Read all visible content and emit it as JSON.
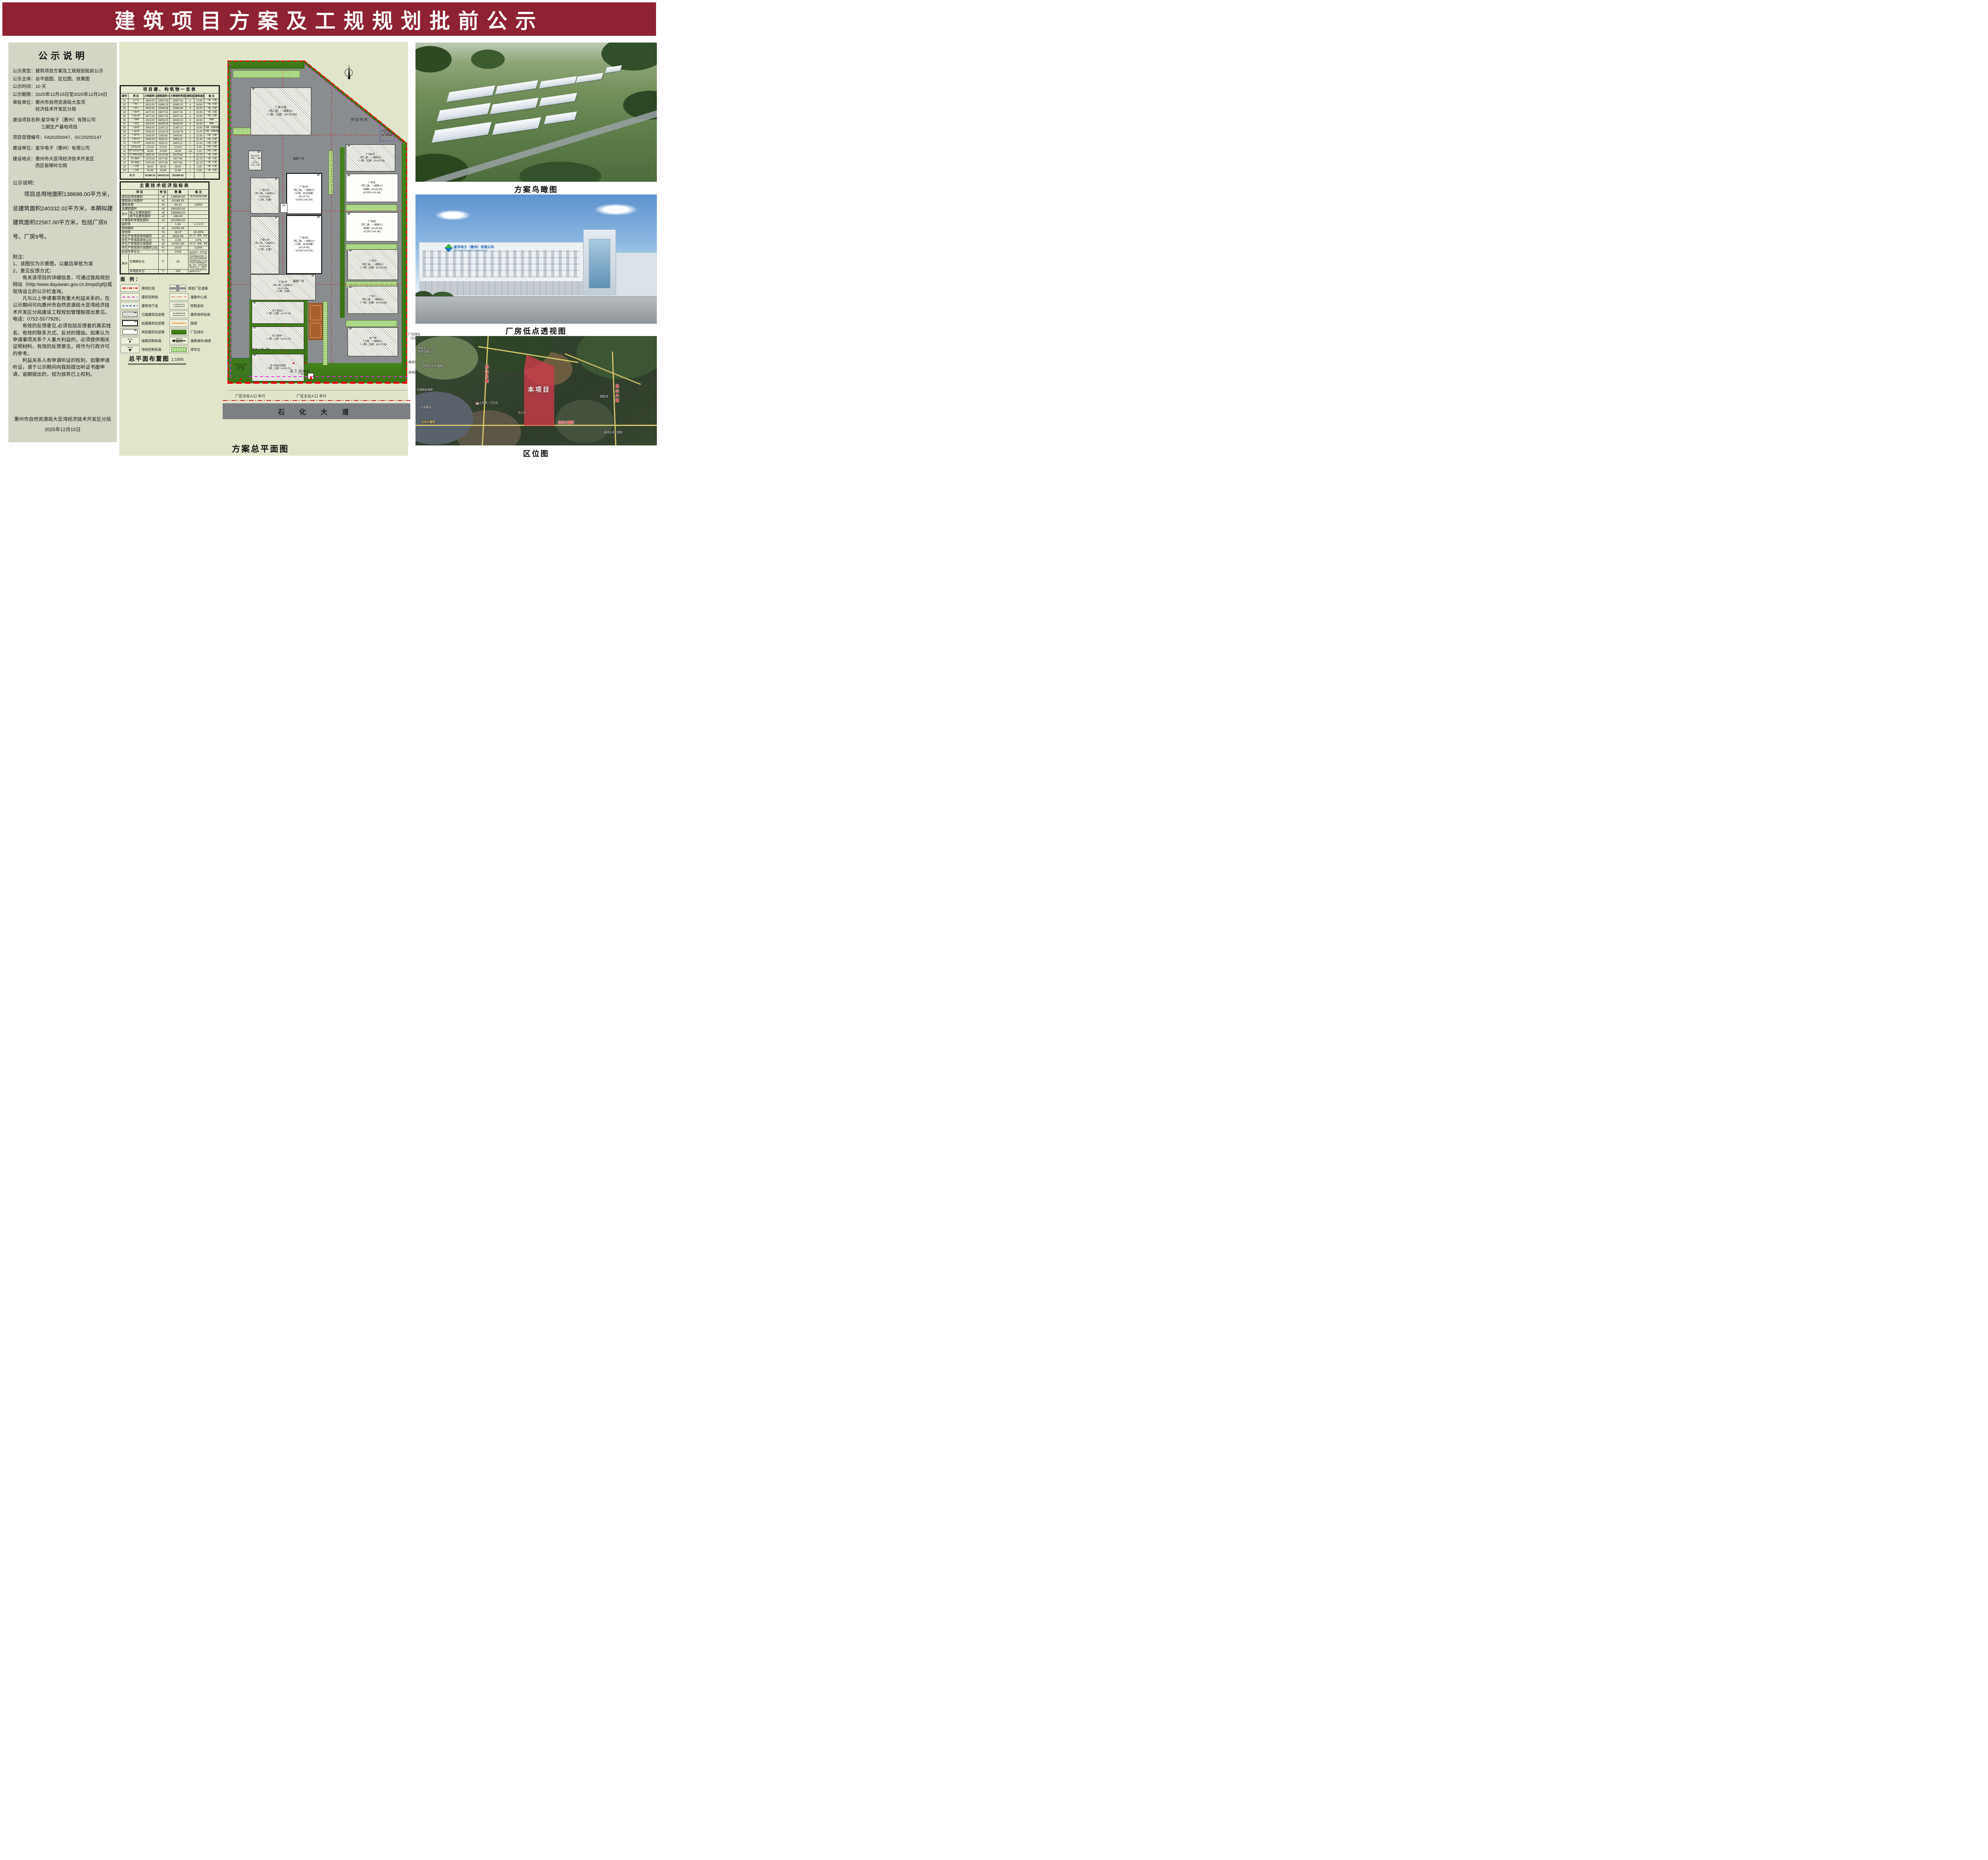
{
  "header": {
    "title": "建筑项目方案及工规规划批前公示"
  },
  "left": {
    "title": "公示说明",
    "fields": [
      {
        "label": "公示类型：",
        "value": "建筑项目方案及工规规划批前公示"
      },
      {
        "label": "公示主体：",
        "value": "总平面图、区位图、效果图"
      },
      {
        "label": "公示时间：",
        "value": "10 天"
      },
      {
        "label": "公示期限：",
        "value": "2025年12月15日至2025年12月24日"
      },
      {
        "label": "审批单位：",
        "value": "惠州市自然资源局大亚湾\n经济技术开发区分局"
      },
      {
        "label": "建设项目名称:",
        "value": "星华电子（惠州）有限公司\n三期生产基地项目"
      },
      {
        "label": "项目受理编号：",
        "value": "FA20250047、GC20250147"
      },
      {
        "label": "建设单位：",
        "value": "星华电子（惠州）有限公司"
      },
      {
        "label": "建设地点：",
        "value": "惠州市大亚湾经济技术开发区\n西区板樟岭北侧"
      }
    ],
    "desc_title": "公示说明：",
    "desc": "项目总用地面积138696.00平方米，总建筑面积240332.02平方米，本期拟建建筑面积22587.00平方米，包括厂房8号、厂房9号。",
    "notes_title": "附注：",
    "notes": [
      "1、该图仅为示意图，以最后审批为准",
      "2、意见反馈方式：",
      "　　有关该项目的详细信息，可通过我局规划网站（http:/www.dayawan.gov.cn.bmpd/gtfj)或现场设立的公示栏查询。",
      "　　凡与以上申请事项有重大利益关系的，在公示期间可向惠州市自然资源局大亚湾经济技术开发区分局建设工程规划管理股提出意见。",
      "电话：0752-5577926；",
      "　　有效的反馈意见,必须包括反馈者的真实姓名、有效的联系方式、反对的理由。如果认为申请事项关系个人重大利益的，必须提供相关证明材料，有效的反馈意见，将作为行政许可的参考。",
      "　　利益关系人有申请听证的权利，如需申请听证，请于公示期间向我局提出听证书面申请，逾期提出的，视为放弃已上权利。"
    ],
    "org": "惠州市自然资源局大亚湾经济技术开发区分局",
    "date": "2025年12月15日"
  },
  "buildings": {
    "title": "项目建、构筑物一览表",
    "headers": [
      "编号",
      "项  目",
      "占地面积㎡",
      "建筑面积㎡",
      "计算容积率面积㎡",
      "建筑层数",
      "建筑高度m",
      "备 注"
    ],
    "rows": [
      {
        "no": "01",
        "name": "主厂房",
        "area": "4606.00",
        "gfa": "18597.63",
        "far": "18597.63",
        "floors": "4",
        "height": "17.85",
        "note": "一期，已建"
      },
      {
        "no": "02",
        "name": "厂房二",
        "area": "4523.00",
        "gfa": "18360.23",
        "far": "18360.23",
        "floors": "4",
        "height": "19.65",
        "note": "一期，已建"
      },
      {
        "no": "03",
        "name": "厂房三",
        "area": "4523.00",
        "gfa": "18344.98",
        "far": "18344.98",
        "floors": "4",
        "height": "20.00",
        "note": "一期，已建"
      },
      {
        "no": "04",
        "name": "厂房6号",
        "area": "4877.00",
        "gfa": "19877.91",
        "far": "19877.91",
        "floors": "4",
        "height": "20.95",
        "note": "一期，已建"
      },
      {
        "no": "05",
        "name": "厂房10号",
        "area": "4877.00",
        "gfa": "19877.91",
        "far": "19877.91",
        "floors": "4",
        "height": "20.95",
        "note": "一期，已建"
      },
      {
        "no": "06",
        "name": "厂房四",
        "area": "4523.00",
        "gfa": "36435.00",
        "far": "36435.00",
        "floors": "8",
        "height": "43.90",
        "note": "四期"
      },
      {
        "no": "07",
        "name": "厂房五",
        "area": "4523.00",
        "gfa": "36435.00",
        "far": "36435.00",
        "floors": "8",
        "height": "43.90",
        "note": "四期"
      },
      {
        "no": "08",
        "name": "厂房8号",
        "area": "5493.00",
        "gfa": "11367.22",
        "far": "11367.22",
        "floors": "2",
        "height": "14.60",
        "note": "三期，本期拟建"
      },
      {
        "no": "09",
        "name": "厂房9号",
        "area": "5400.00",
        "gfa": "11219.78",
        "far": "11219.78",
        "floors": "2",
        "height": "14.70",
        "note": "三期，本期拟建"
      },
      {
        "no": "10",
        "name": "厂房7号",
        "area": "3200.00",
        "gfa": "3240.63",
        "far": "6440.63",
        "floors": "1",
        "height": "11.00",
        "note": "二期，已建"
      },
      {
        "no": "11",
        "name": "厂房11号",
        "area": "4200.00",
        "gfa": "4253.12",
        "far": "8453.12",
        "floors": "1",
        "height": "11.20",
        "note": "二期，已建"
      },
      {
        "no": "12",
        "name": "厂房12号",
        "area": "4200.00",
        "gfa": "4253.12",
        "far": "8453.12",
        "floors": "1",
        "height": "11.10",
        "note": "二期，已建"
      },
      {
        "no": "13",
        "name": "化学品仓库",
        "area": "273.00",
        "gfa": "273.00",
        "far": "273.00",
        "floors": "1",
        "height": "5.00",
        "note": "二期，已建"
      },
      {
        "no": "14",
        "name": "地下生活/生产/消防水池及泵房",
        "area": "38.69",
        "gfa": "374.69",
        "far": "38.69",
        "floors": "-1/1",
        "height": "3.10",
        "note": "二期，已建"
      },
      {
        "no": "15",
        "name": "员工宿舍及食堂",
        "area": "3695.00",
        "gfa": "19178.82",
        "far": "19178.82",
        "floors": "7",
        "height": "22.75",
        "note": "一期，已建"
      },
      {
        "no": "16",
        "name": "员工宿舍一",
        "area": "1075.00",
        "gfa": "9077.66",
        "far": "9077.66",
        "floors": "7",
        "height": "22.75",
        "note": "一期，已建"
      },
      {
        "no": "17",
        "name": "员工宿舍二",
        "area": "1075.00",
        "gfa": "9077.66",
        "far": "9077.66",
        "floors": "7",
        "height": "22.75",
        "note": "一期，已建"
      },
      {
        "no": "18",
        "name": "门卫室",
        "area": "36.00",
        "gfa": "36.00",
        "far": "36.00",
        "floors": "1",
        "height": "3.35",
        "note": "一期，已建"
      },
      {
        "no": "19",
        "name": "门卫室",
        "area": "51.66",
        "gfa": "51.66",
        "far": "51.66",
        "floors": "1",
        "height": "3.35",
        "note": "一期，已建"
      }
    ],
    "total_label": "合  计",
    "total": {
      "area": "61189.35",
      "gfa": "240332.02",
      "far": "251596.02"
    }
  },
  "indicators": {
    "title": "主要技术经济指标表",
    "headers": [
      "项    目",
      "单 位",
      "数  量",
      "备 注"
    ],
    "qizhong": "其中",
    "rows": [
      {
        "label": "规划总用地面积",
        "unit": "㎡",
        "value": "138696.00",
        "note": "合计约208.04亩"
      },
      {
        "label": "建筑物占地面积",
        "unit": "㎡",
        "value": "61189.35",
        "note": ""
      },
      {
        "label": "建筑系数",
        "unit": "%",
        "value": "44.12",
        "note": "≥30%"
      },
      {
        "label": "总建筑面积",
        "unit": "㎡",
        "value": "240332.02",
        "note": ""
      },
      {
        "label": "地上总建筑面积",
        "unit": "㎡",
        "value": "239996.02",
        "note": ""
      },
      {
        "label": "地下总建筑面积",
        "unit": "㎡",
        "value": "336.00",
        "note": ""
      },
      {
        "label": "计算容积率建筑面积",
        "unit": "㎡",
        "value": "251596.02",
        "note": ""
      },
      {
        "label": "容积率",
        "unit": "",
        "value": "1.81",
        "note": "1.2-2.0"
      },
      {
        "label": "绿地面积",
        "unit": "㎡",
        "value": "22293.46",
        "note": ""
      },
      {
        "label": "绿地率",
        "unit": "%",
        "value": "16.07",
        "note": "15-20%"
      },
      {
        "label": "非生产性用房用地面积",
        "unit": "㎡",
        "value": "5932.66",
        "note": "含门卫、宿舍、食堂"
      },
      {
        "label": "非生产性用房用地占比",
        "unit": "%",
        "value": "4.28",
        "note": "≤7%"
      },
      {
        "label": "非生产性用房计容面积",
        "unit": "㎡",
        "value": "37421.80",
        "note": "含门卫、宿舍、食堂"
      },
      {
        "label": "非生产性用房计容面积占比",
        "unit": "%",
        "value": "14.87",
        "note": "≤15%"
      },
      {
        "label": "机动车停车位",
        "unit": "个",
        "value": "1018",
        "note": ""
      },
      {
        "label": "无障碍车位",
        "unit": "个",
        "value": "20",
        "note": ""
      },
      {
        "label": "充电桩车位",
        "unit": "个",
        "value": "102",
        "note": ""
      }
    ],
    "parking_note": "地上停车位；生产区设施停车位＞0.3个/100平方米建筑面积计算；行政办公及生活服务配套区设施停车位1.0个/100平方米计容建筑面积计算。其中：生产区设施停车位643个；行政办公及生活服务配套区设施停车位375个"
  },
  "legend": {
    "title": "图 例：",
    "items": [
      "用地红线",
      "建筑控制线",
      "建筑地下室",
      "已建建筑及层数",
      "拟建建筑及层数",
      "规划建筑及层数",
      "道路控制标高",
      "场地控制标高",
      "规划厂区道路",
      "道路中心线",
      "控制坐标",
      "建筑地坪标高",
      "围墙",
      "厂区绿化",
      "道路坡向/坡度",
      "停车位"
    ],
    "sym": {
      "fl_built": "4F",
      "fl_prop": "1F",
      "fl_plan": "4F",
      "elev_road": "40.65",
      "elev_site": "40.00",
      "coord_x": "X=2613453.570",
      "coord_y": "Y=39448814.861",
      "floor_elev": "±0.000=40.30",
      "slope_t": "道路纵坡",
      "slope_b": "道路长度"
    }
  },
  "plan": {
    "buildings": {
      "b10": {
        "label": "厂房10号\n（丙二类，一级耐火）\n（一期，已建）(H=20.95)",
        "tag": "4F"
      },
      "b6": {
        "label": "厂房6号\n（丙二类，一级耐火）\n（一期，已建）(H=20.95)",
        "tag": "4F"
      },
      "b5": {
        "label": "厂房五\n（丙二类，一级耐火）\n（四期）(H=43.90)\n±0.000 (=41.46)",
        "tag": "8F"
      },
      "b4": {
        "label": "厂房四\n（丙二类，一级耐火）\n（四期）(H=43.90)\n±0.000 (=41.46)",
        "tag": "8F"
      },
      "b3": {
        "label": "厂房三\n（丙二类，一级耐火）\n（一期，已建）(H=20.00)",
        "tag": "4F"
      },
      "b2": {
        "label": "厂房二\n（丙二类，一级耐火）\n（一期，已建）(H=19.65)",
        "tag": "4F"
      },
      "main": {
        "label": "主厂房\n（丁类，一级耐火）\n（一期，已建）(H=17.85)",
        "tag": "4F"
      },
      "b11": {
        "label": "厂房11号\n（丙二类，二级耐火）\nH=11.20m\n（二期，已建）",
        "tag": "1F"
      },
      "b9": {
        "label": "厂房9号\n（丙二类，一级耐火）\n（三期、本次拟建）\n(H=14.70)\n±0.000 (=41.90)",
        "tag": "2F"
      },
      "b12": {
        "label": "厂房12号\n（丙二类，二级耐火）\nH=11.10m\n（二期，已建）",
        "tag": "1F"
      },
      "b8": {
        "label": "厂房8号\n（丙二类，一级耐火）\n（三期、本次拟建）\n(H=14.60)\n±0.000 (=41.50)",
        "tag": "2F"
      },
      "b7": {
        "label": "厂房7号\n（丙二类，二级耐火）\nH=11.00m\n（二期，已建）",
        "tag": "1F"
      },
      "chem": {
        "label": "化学品仓库\n（甲类，一级耐火）\nH=5.00m\n（二期，已建）",
        "tag": "1F"
      },
      "d2": {
        "label": "员工宿舍二\n（一期，已建）(H=22.75)",
        "tag": "7F"
      },
      "d1": {
        "label": "员工宿舍一\n（一期，已建）(H=22.75)",
        "tag": "7F"
      },
      "dc": {
        "label": "员工宿舍及食堂\n（一期，已建）(H=22.75)",
        "tag": "7F"
      },
      "risk": {
        "label": "地下风险应急池\n(500m3)\n一期，已建构筑物",
        "tag": "1F"
      },
      "pool": {
        "label": "地下生活/生产/消防\n水池及泵房\n（二期，已建）",
        "tag": "1F"
      }
    },
    "texts": {
      "reserved": "预留用地",
      "plaza": "装卸广场",
      "corridor": "连廊",
      "guard1": "守卫室（一期，已建）",
      "guard2": "守卫室\n（一期，已建）",
      "staff_entrance": "员工出入口",
      "side_entrance": "厂区次出入口 车行",
      "main_entrance": "厂区主出入口 车行",
      "green_note": "厂区绿化\n（已建）",
      "ctrl_line": "建筑控制线",
      "red_line": "用地红线",
      "road": "石 化 大 道"
    }
  },
  "captions": {
    "site_plan": "总平面布置图",
    "scale": "1:1000",
    "master": "方案总平面图",
    "aerial": "方案鸟瞰图",
    "perspective": "厂房低点透视图",
    "location": "区位图"
  },
  "factory": {
    "logo_cn": "星华电子（惠州）有限公司",
    "logo_en": "Star China Electronic (Hui Zhou) Ltd"
  },
  "map": {
    "project": "本项目",
    "road_left": "龙山五路",
    "road_right": "龙山六路",
    "road_bottom1": "石化大道西",
    "road_bottom2": "石化大道西",
    "poi_pharmacy": "华晖大\n药房卓越分店",
    "poi_biguiyuan": "碧桂园太东·蜜柚",
    "poi_coast": "东部蔚蓝海岸",
    "poi_tianrun": "天润嘉园",
    "poi_clinic": "上田第一卫生站",
    "poi_guanshanyue": "观山悦",
    "poi_yulanwan": "御蓝湾",
    "poi_hotel": "星河山水大酒店"
  }
}
